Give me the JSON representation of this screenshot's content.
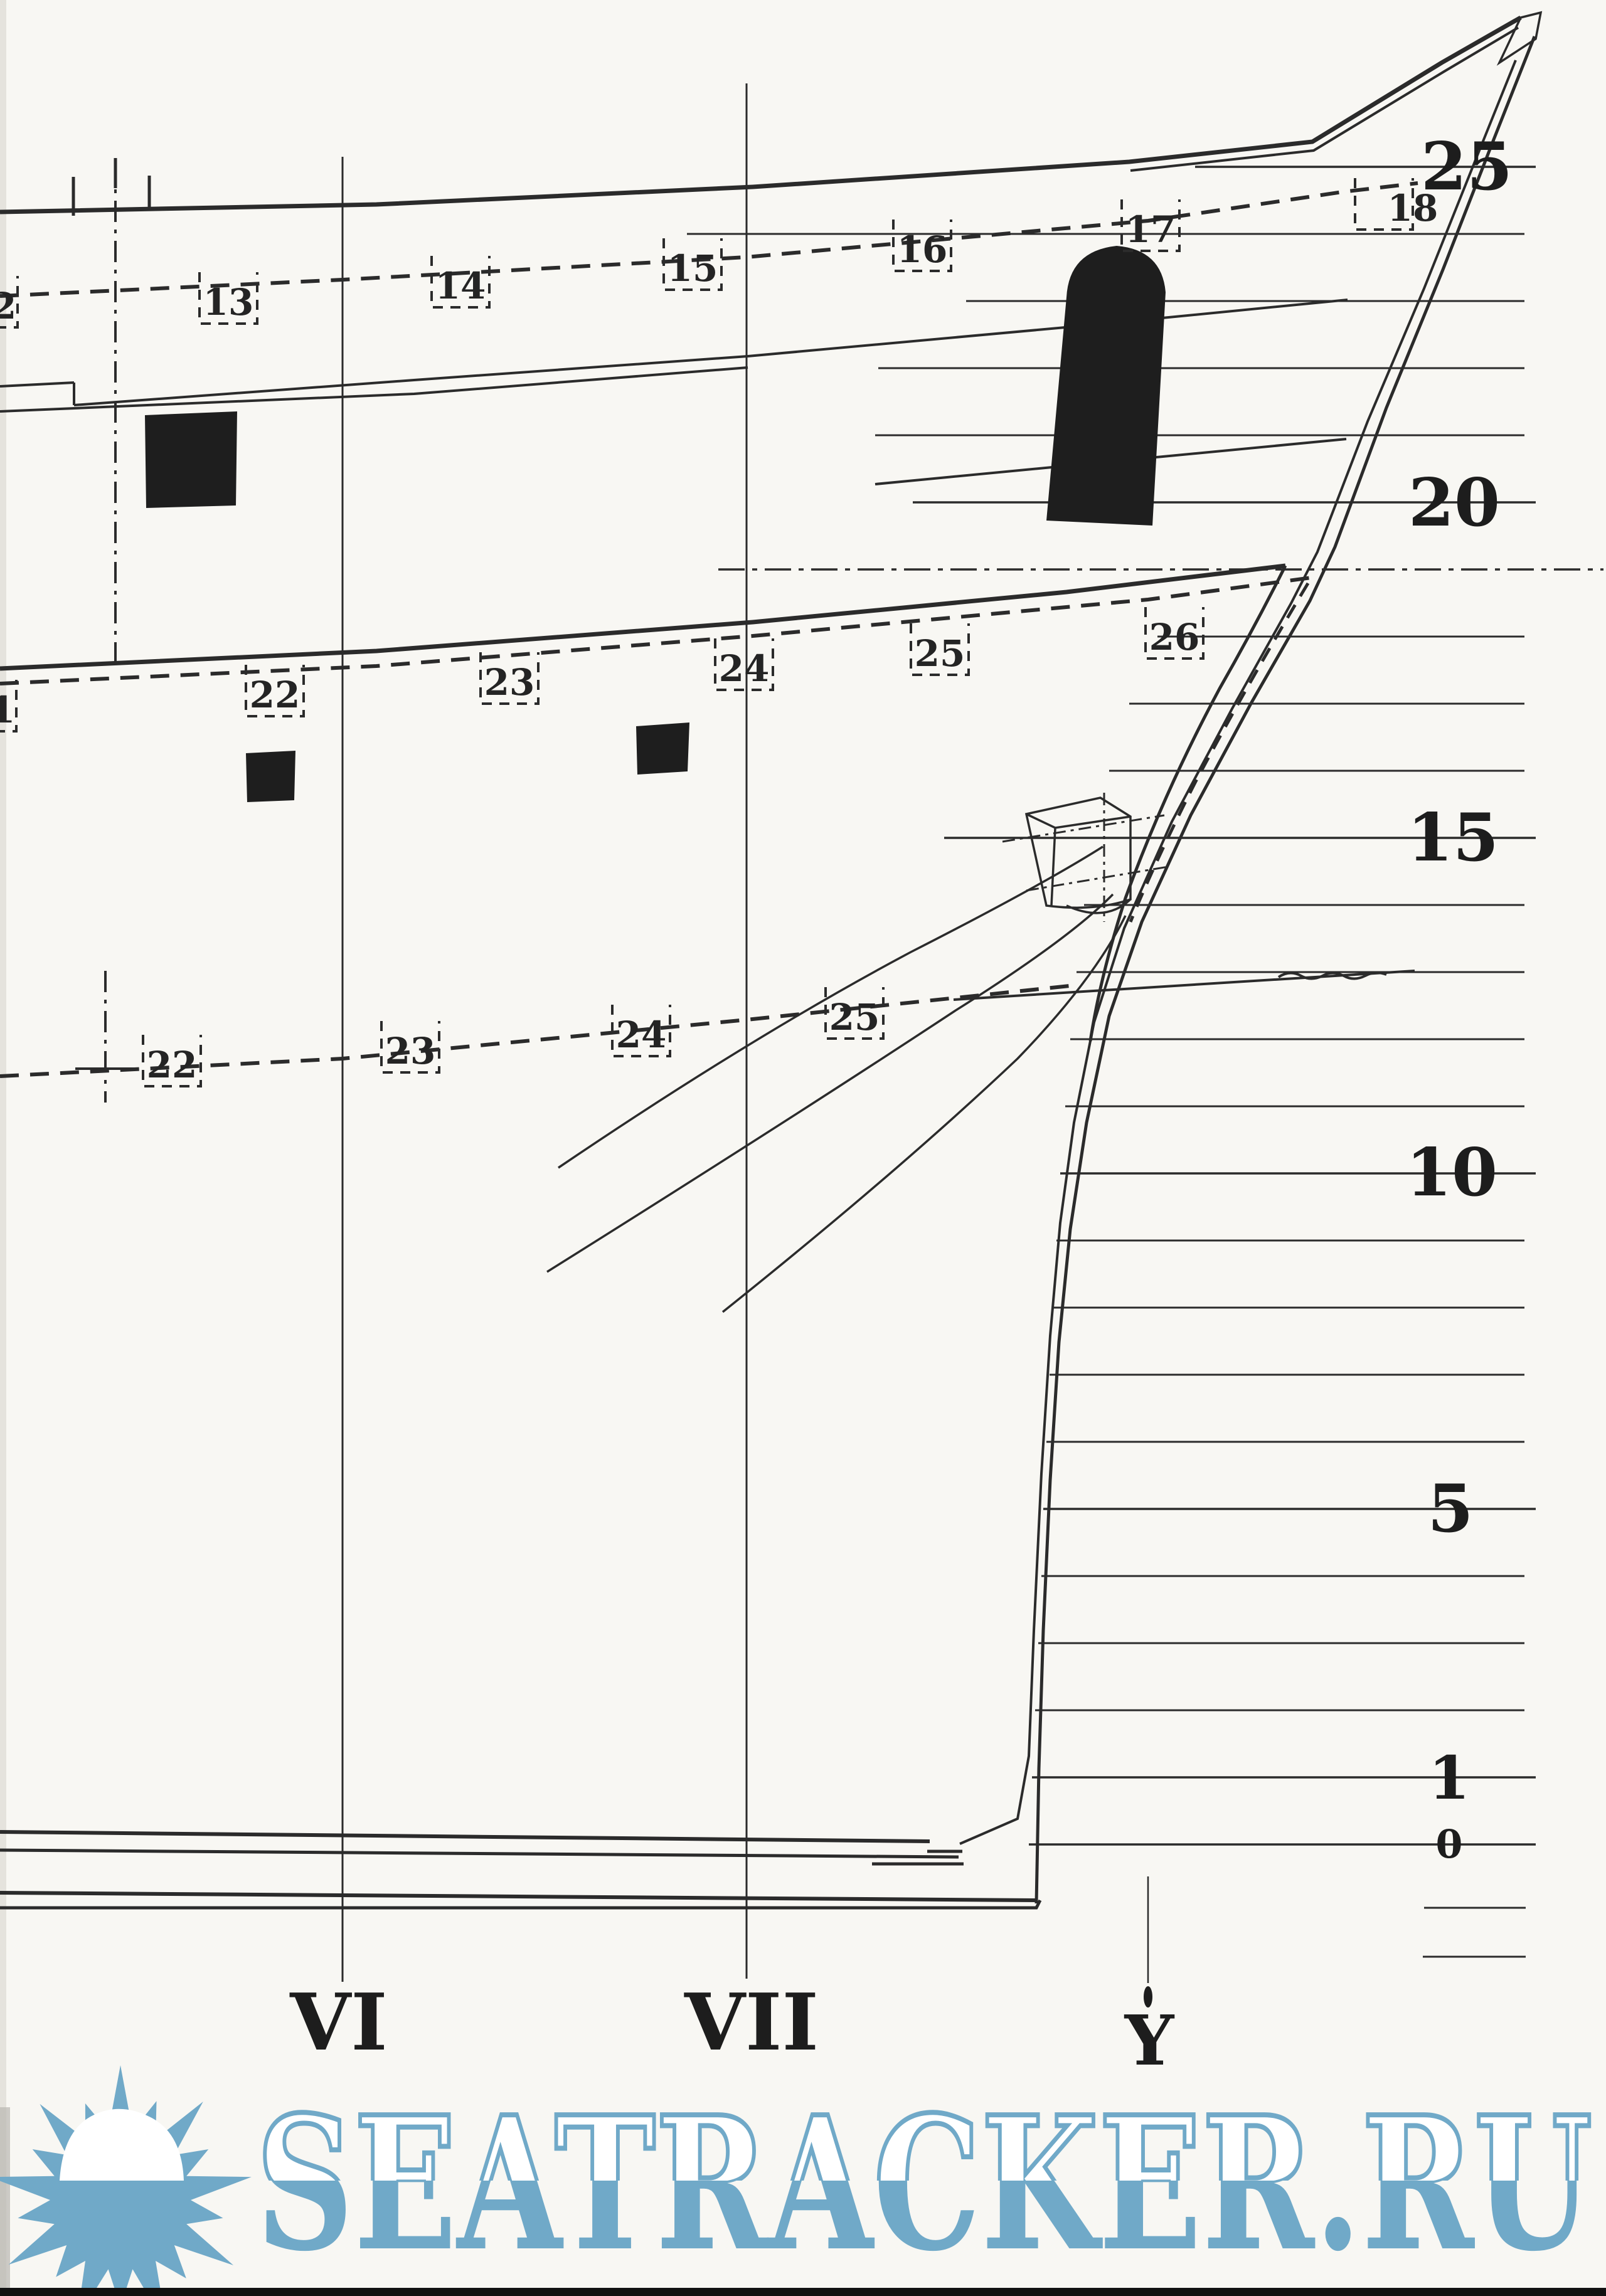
{
  "meta": {
    "description": "Scanned ship hull lines plan, bow section (sheer profile)",
    "paper_color": "#f8f7f3",
    "ink_color": "#2b2b2b",
    "gunport_color": "#1e1e1e",
    "watermark_blue": "#70a9c8"
  },
  "frame_labels": {
    "upper_row": [
      "2",
      "13",
      "14",
      "15",
      "16",
      "17",
      "18"
    ],
    "middle_row": [
      "1",
      "22",
      "23",
      "24",
      "25",
      "26"
    ],
    "lower_row": [
      "22",
      "23",
      "24",
      "25"
    ]
  },
  "draft_scale": {
    "values": [
      "25",
      "20",
      "15",
      "10",
      "5",
      "1",
      "0"
    ]
  },
  "stations": {
    "labels": [
      "VI",
      "VII",
      "Y"
    ]
  },
  "watermark": {
    "text": "SEATRACKER.RU"
  }
}
